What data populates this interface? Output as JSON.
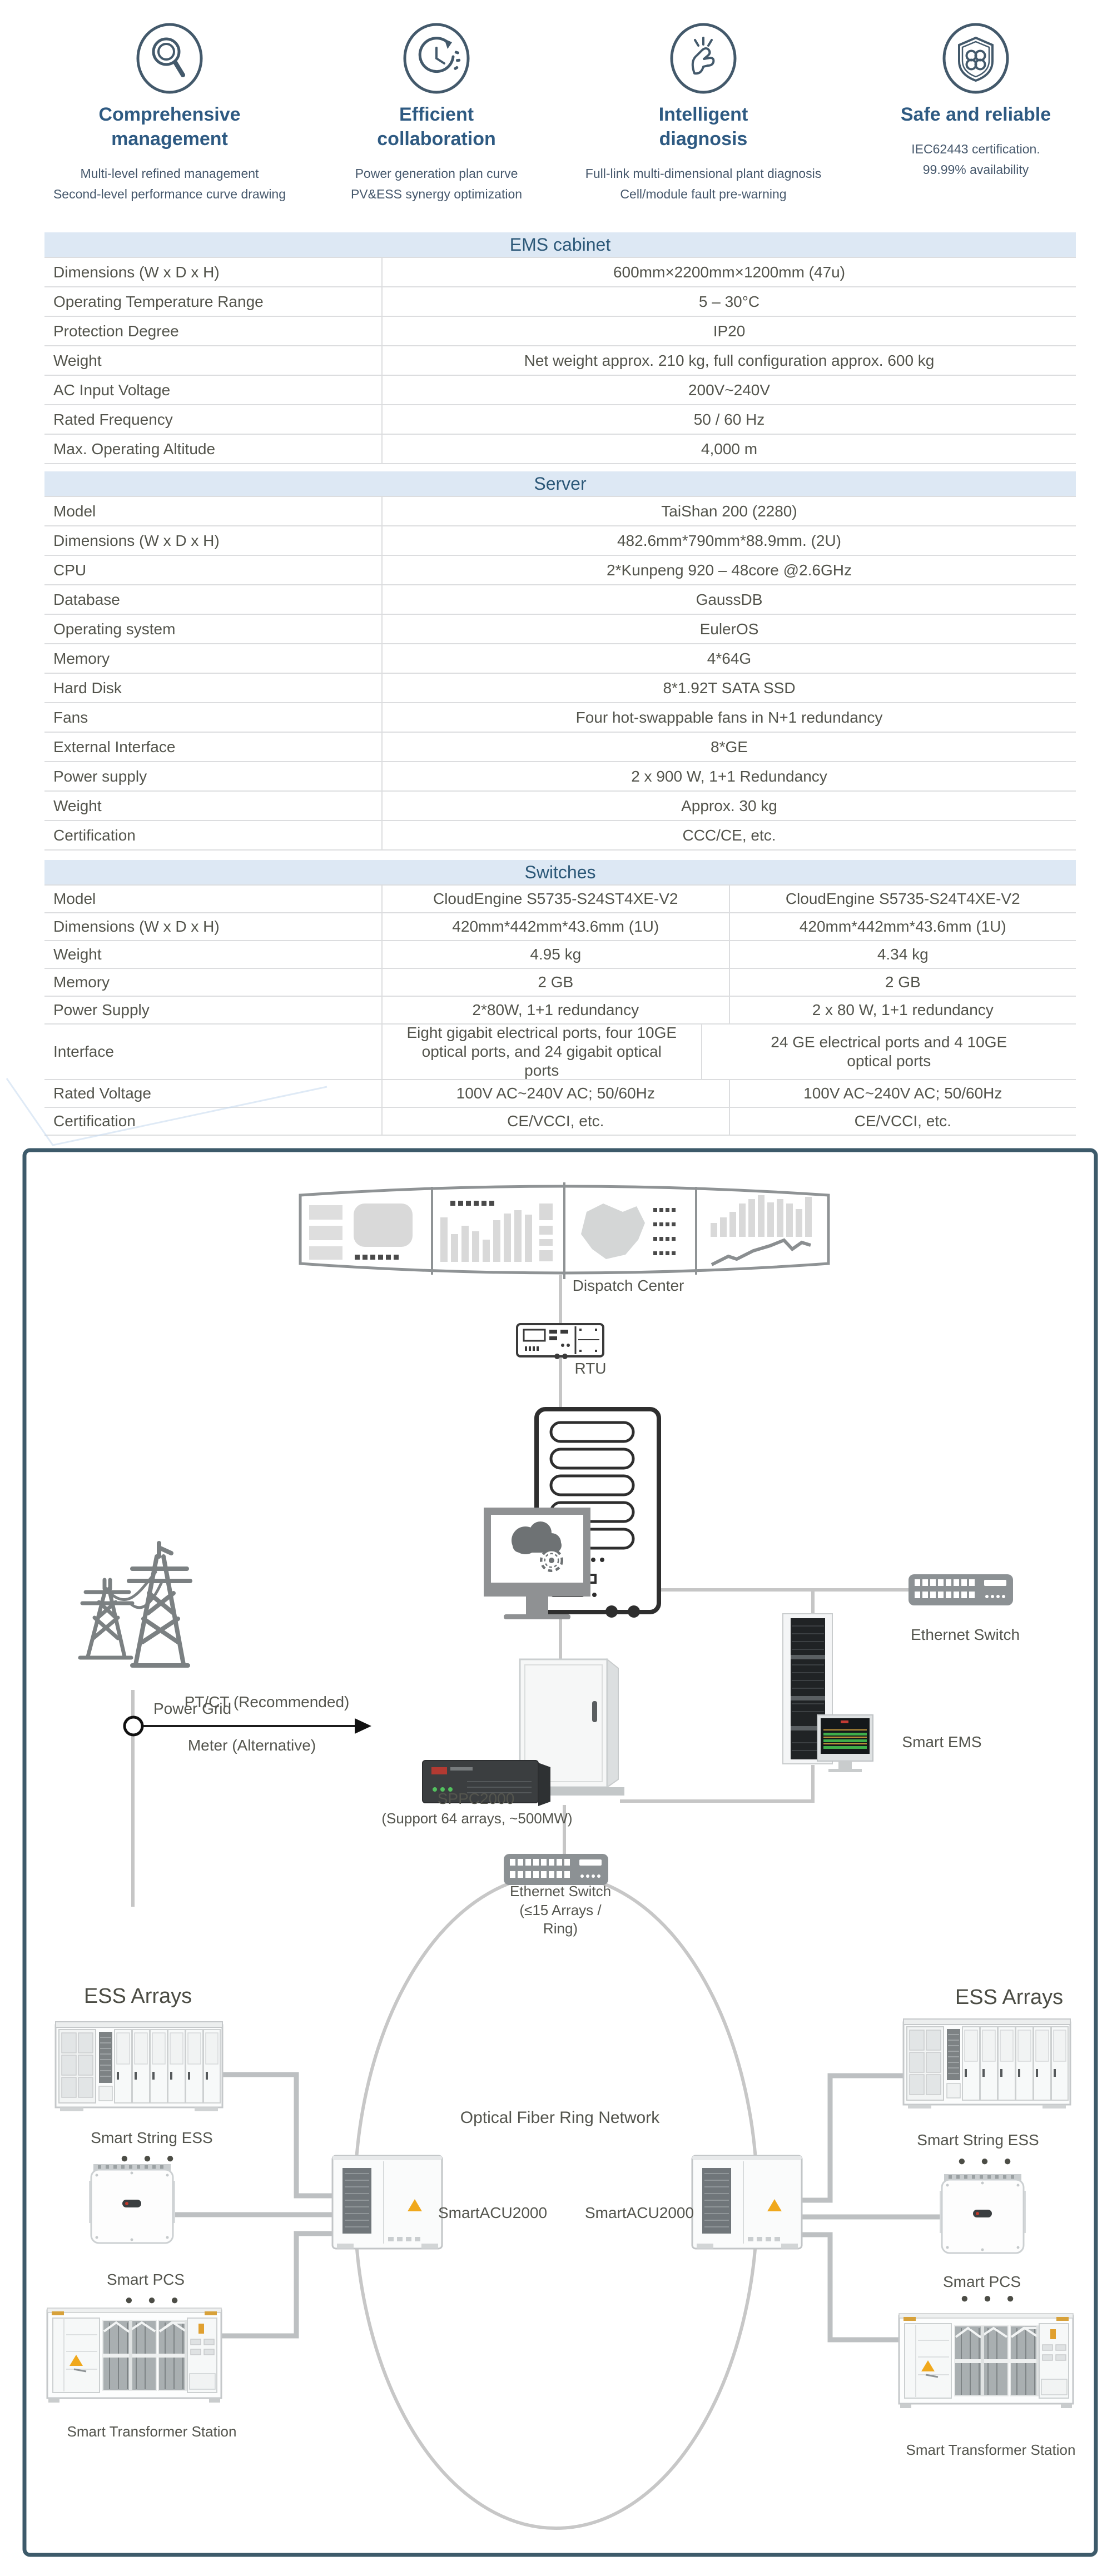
{
  "colors": {
    "accent_blue": "#2e5a82",
    "band_bg": "#dde8f4",
    "band_text": "#2c5878",
    "body_text": "#53544c",
    "diagram_border": "#3d5a6a",
    "connector_gray": "#c6c6c6",
    "device_gray": "#8c9194",
    "warning_yellow": "#efa820"
  },
  "features": [
    {
      "icon": "magnifier-icon",
      "title": "Comprehensive management",
      "desc1": "Multi-level refined management",
      "desc2": "Second-level performance curve drawing"
    },
    {
      "icon": "cycle-clock-icon",
      "title": "Efficient collaboration",
      "desc1": "Power generation plan curve",
      "desc2": "PV&ESS  synergy optimization"
    },
    {
      "icon": "snap-finger-icon",
      "title": "Intelligent diagnosis",
      "desc1": "Full-link multi-dimensional plant diagnosis",
      "desc2": "Cell/module fault pre-warning"
    },
    {
      "icon": "shield-clover-icon",
      "title": "Safe and reliable",
      "desc1": "IEC62443 certification.",
      "desc2": "99.99% availability"
    }
  ],
  "tables": {
    "ems": {
      "title": "EMS cabinet",
      "rows": [
        {
          "label": "Dimensions (W x D x H)",
          "value": "600mm×2200mm×1200mm (47u)"
        },
        {
          "label": "Operating Temperature Range",
          "value": "5 – 30°C"
        },
        {
          "label": "Protection Degree",
          "value": "IP20"
        },
        {
          "label": "Weight",
          "value": "Net weight approx. 210 kg, full configuration approx. 600 kg"
        },
        {
          "label": "AC Input Voltage",
          "value": "200V~240V"
        },
        {
          "label": "Rated Frequency",
          "value": "50 / 60 Hz"
        },
        {
          "label": "Max. Operating Altitude",
          "value": "4,000 m"
        }
      ]
    },
    "server": {
      "title": "Server",
      "rows": [
        {
          "label": "Model",
          "value": "TaiShan 200 (2280)"
        },
        {
          "label": "Dimensions (W x D x H)",
          "value": "482.6mm*790mm*88.9mm. (2U)"
        },
        {
          "label": "CPU",
          "value": "2*Kunpeng 920 – 48core @2.6GHz"
        },
        {
          "label": "Database",
          "value": "GaussDB"
        },
        {
          "label": "Operating system",
          "value": "EulerOS"
        },
        {
          "label": "Memory",
          "value": "4*64G"
        },
        {
          "label": "Hard Disk",
          "value": "8*1.92T SATA SSD"
        },
        {
          "label": "Fans",
          "value": "Four hot-swappable fans in N+1 redundancy"
        },
        {
          "label": "External Interface",
          "value": "8*GE"
        },
        {
          "label": "Power supply",
          "value": "2 x 900 W, 1+1 Redundancy"
        },
        {
          "label": "Weight",
          "value": "Approx. 30 kg"
        },
        {
          "label": "Certification",
          "value": "CCC/CE, etc."
        }
      ]
    },
    "switches": {
      "title": "Switches",
      "rows": [
        {
          "label": "Model",
          "value1": "CloudEngine S5735-S24ST4XE-V2",
          "value2": "CloudEngine S5735-S24T4XE-V2"
        },
        {
          "label": "Dimensions (W x D x H)",
          "value1": "420mm*442mm*43.6mm (1U)",
          "value2": "420mm*442mm*43.6mm (1U)"
        },
        {
          "label": "Weight",
          "value1": "4.95 kg",
          "value2": "4.34 kg"
        },
        {
          "label": "Memory",
          "value1": "2 GB",
          "value2": "2 GB"
        },
        {
          "label": "Power Supply",
          "value1": "2*80W, 1+1 redundancy",
          "value2": "2 x 80 W, 1+1 redundancy"
        },
        {
          "label": "Interface",
          "value1": "Eight gigabit electrical ports, four 10GE optical ports, and 24 gigabit optical ports",
          "value2": "24 GE electrical ports and 4 10GE optical ports"
        },
        {
          "label": "Rated Voltage",
          "value1": "100V AC~240V AC; 50/60Hz",
          "value2": "100V AC~240V AC; 50/60Hz"
        },
        {
          "label": "Certification",
          "value1": "CE/VCCI, etc.",
          "value2": "CE/VCCI, etc."
        }
      ]
    }
  },
  "diagram": {
    "dispatch_center": "Dispatch Center",
    "rtu": "RTU",
    "power_grid": "Power Grid",
    "pt_ct": "PT/CT (Recommended)",
    "meter": "Meter (Alternative)",
    "sppc_name": "SPPC2000",
    "sppc_sub": "(Support 64 arrays, ~500MW)",
    "ethernet_switch": "Ethernet Switch",
    "smart_ems": "Smart EMS",
    "ring_switch_line1": "Ethernet Switch",
    "ring_switch_line2": "(≤15 Arrays /",
    "ring_switch_line3": "Ring)",
    "optical_ring": "Optical Fiber Ring Network",
    "smartacu_left": "SmartACU2000",
    "smartacu_right": "SmartACU2000",
    "ess_arrays_left": "ESS Arrays",
    "ess_arrays_right": "ESS Arrays",
    "smart_string_ess_left": "Smart String ESS",
    "smart_string_ess_right": "Smart String ESS",
    "smart_pcs_left": "Smart PCS",
    "smart_pcs_right": "Smart PCS",
    "smart_transformer_left": "Smart Transformer Station",
    "smart_transformer_right": "Smart Transformer Station",
    "ellipsis_string_left": "●  ●  ●",
    "ellipsis_string_right": "●  ●  ●",
    "ellipsis_pcs_left": "●  ●  ●",
    "ellipsis_pcs_right": "●  ●  ●"
  }
}
